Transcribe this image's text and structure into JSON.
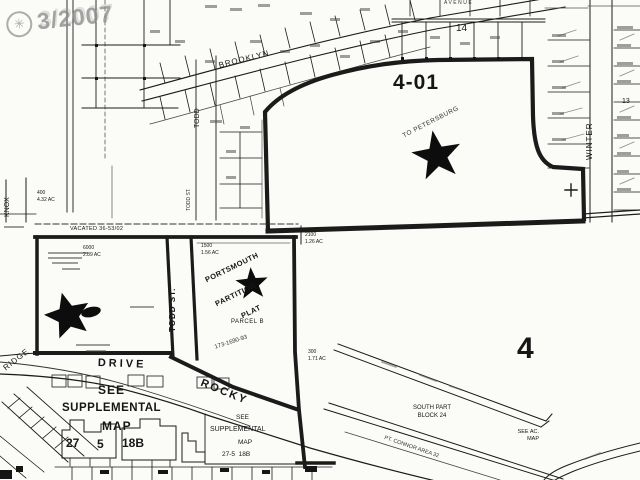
{
  "stamp": {
    "symbol": "✳",
    "date": "3/2007"
  },
  "streets": {
    "avenue": "AVENUE",
    "brooklyn": "BROOKLYN",
    "winter": "WINTER",
    "todd": "TODD",
    "todd_st_upper": "TODD ST.",
    "todd_st": "TODD ST.",
    "knox": "KNOX",
    "drive": "DRIVE",
    "rocky": "ROCKY",
    "ridge": "RIDGE",
    "connor": "PT. CONNOR AREA 32"
  },
  "labels": {
    "block_401": "4-01",
    "to_petersburg": "TO PETERSBURG",
    "lot_14": "14",
    "lot_13": "13",
    "section_4": "4",
    "vacated": "VACATED 36-53/02",
    "portsmouth_1": "PORTSMOUTH",
    "portsmouth_2": "PARTITION",
    "portsmouth_3": "PLAT",
    "parcel_b": "PARCEL B",
    "plat_vol": "173-1690-93",
    "lot1500_num": "1500",
    "lot1500_area": "1.56 AC",
    "lot6000_num": "6000",
    "lot6000_area": "2.89 AC",
    "lot400_num": "400",
    "lot400_area": "4.32 AC",
    "lot2100_num": "2100",
    "lot2100_area": "1.26 AC",
    "lot300_num": "300",
    "lot300_area": "1.71 AC",
    "south_part_1": "SOUTH PART",
    "south_part_2": "BLOCK 24",
    "see_ac_1": "SEE AC.",
    "see_ac_2": "MAP"
  },
  "supplemental_large": {
    "see": "SEE",
    "supplemental": "SUPPLEMENTAL",
    "map": "MAP",
    "ref_1": "27",
    "ref_2": "5",
    "ref_3": "18B"
  },
  "supplemental_small": {
    "see": "SEE",
    "supplemental": "SUPPLEMENTAL",
    "map": "MAP",
    "ref": "27-5  18B"
  }
}
